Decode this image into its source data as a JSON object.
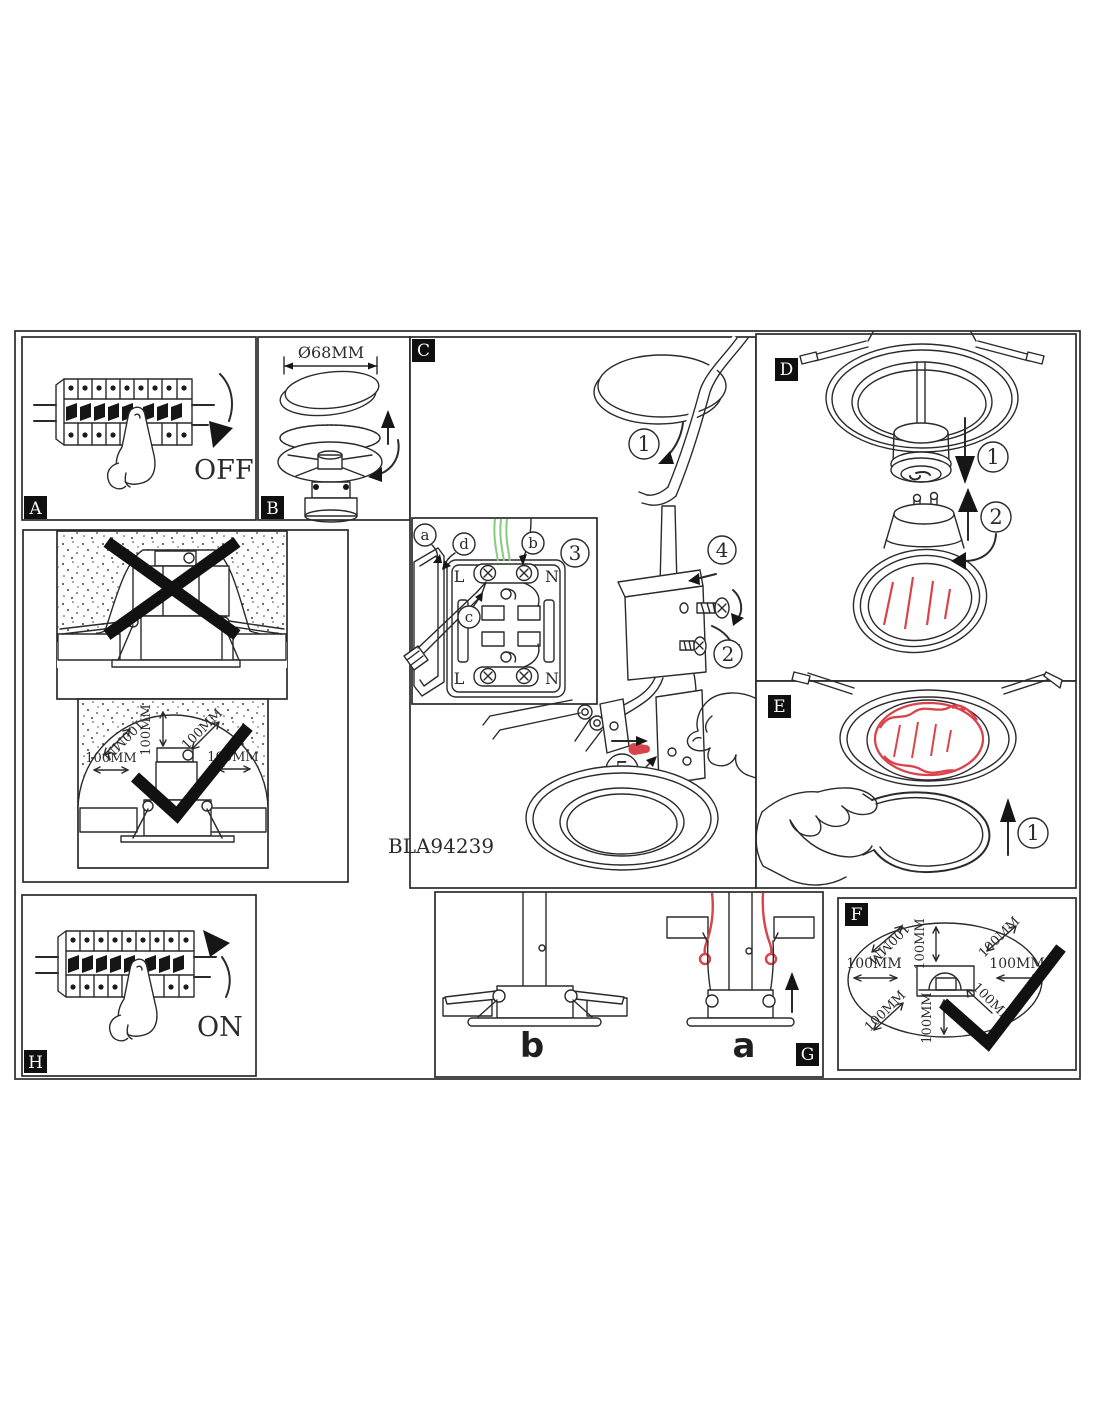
{
  "product": {
    "code": "BLA94239"
  },
  "labels": {
    "power_off": "OFF",
    "power_on": "ON",
    "hole_diameter": "Ø68MM",
    "clearance": "100MM"
  },
  "panels": {
    "a": {
      "tag": "A"
    },
    "b": {
      "tag": "B"
    },
    "c": {
      "tag": "C",
      "step1": "1",
      "step2": "2",
      "step3": "3",
      "step4": "4",
      "step5": "5",
      "wire_a": "a",
      "wire_b": "b",
      "wire_c": "c",
      "wire_d": "d",
      "terminal_live": "L",
      "terminal_neutral": "N"
    },
    "d": {
      "tag": "D",
      "step1": "1",
      "step2": "2"
    },
    "e": {
      "tag": "E",
      "step1": "1"
    },
    "f": {
      "tag": "F"
    },
    "g": {
      "tag": "G",
      "fig_installed": "b",
      "fig_insert": "a"
    },
    "h": {
      "tag": "H"
    }
  },
  "colors": {
    "line": "#2a2a2a",
    "red": "#d8444b",
    "green": "#86cb80"
  }
}
